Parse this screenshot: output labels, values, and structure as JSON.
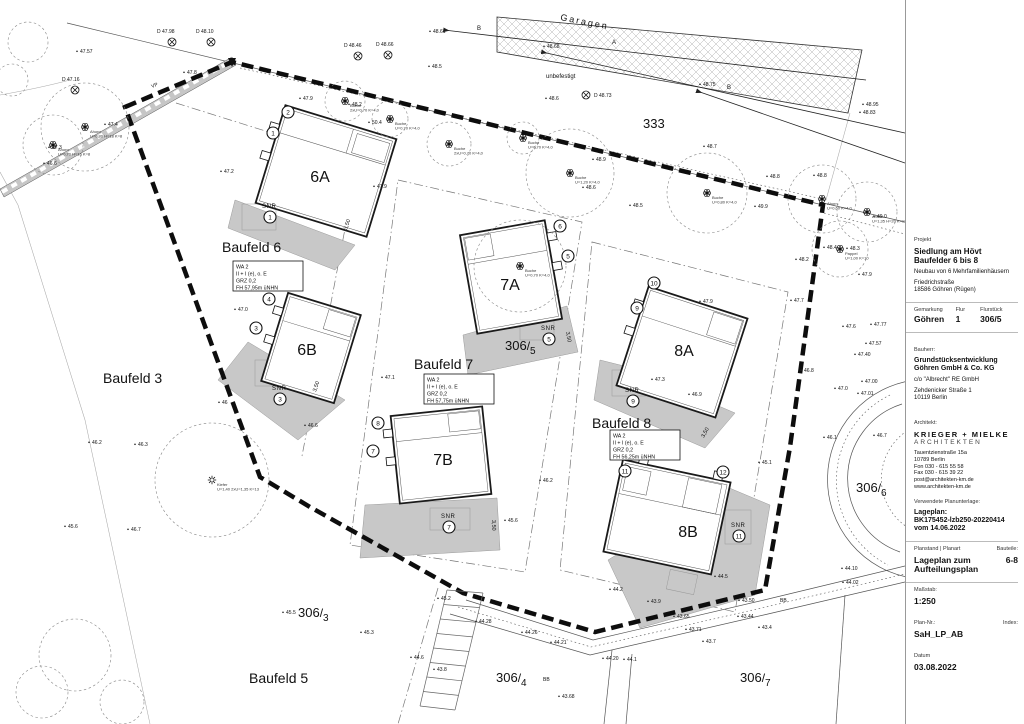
{
  "accent_colors": {
    "line_black": "#111111",
    "terrace_gray": "#c8c8c8",
    "crown_gray": "#858585"
  },
  "title_block": {
    "project": {
      "label": "Projekt",
      "title_line1": "Siedlung am Hövt",
      "title_line2": "Baufelder  6 bis 8",
      "description": "Neubau von 6 Mehrfamilienhäusern",
      "street": "Friedrichstraße",
      "city": "18586 Göhren (Rügen)"
    },
    "cadastre": {
      "gemarkung_label": "Gemarkung",
      "flur_label": "Flur",
      "flurstueck_label": "Flurstück",
      "gemarkung": "Göhren",
      "flur": "1",
      "flurstueck": "306/5"
    },
    "client": {
      "label": "Bauherr:",
      "name_line1": "Grundstücksentwicklung",
      "name_line2": "Göhren GmbH & Co. KG",
      "co": "c/o \"Albrecht\" RE GmbH",
      "street": "Zehdenicker Straße 1",
      "city": "10119 Berlin"
    },
    "architect": {
      "label": "Architekt:",
      "name": "KRIEGER + MIELKE",
      "subtitle": "ARCHITEKTEN",
      "street": "Tauentzienstraße 15a",
      "city": "10789 Berlin",
      "phone": "Fon 030 - 615 55 58",
      "fax": "Fax 030 - 615 39 22",
      "email": "post@architekten-km.de",
      "web": "www.architekten-km.de"
    },
    "plan_basis": {
      "label": "Verwendete Planunterlage:",
      "line1": "Lageplan:",
      "line2": "BK175452-lzb250-20220414",
      "line3": "vom 14.06.2022"
    },
    "plan_info": {
      "state_label": "Planstand | Planart",
      "component_label": "Bauteile:",
      "title_line1": "Lageplan zum",
      "title_line2": "Aufteilungsplan",
      "component": "6-8",
      "scale_label": "Maßstab:",
      "scale": "1:250",
      "plan_no_label": "Plan-Nr.:",
      "index_label": "Index:",
      "plan_no": "SaH_LP_AB",
      "date_label": "Datum",
      "date": "03.08.2022"
    }
  },
  "plan": {
    "baufeld_labels": [
      {
        "t": "Baufeld 6",
        "x": 222,
        "y": 252
      },
      {
        "t": "Baufeld 7",
        "x": 414,
        "y": 369
      },
      {
        "t": "Baufeld 8",
        "x": 592,
        "y": 428
      },
      {
        "t": "Baufeld 3",
        "x": 103,
        "y": 383
      },
      {
        "t": "Baufeld 5",
        "x": 249,
        "y": 683
      }
    ],
    "building_labels": [
      {
        "t": "6A",
        "x": 320,
        "y": 182
      },
      {
        "t": "6B",
        "x": 307,
        "y": 355
      },
      {
        "t": "7A",
        "x": 510,
        "y": 290
      },
      {
        "t": "7B",
        "x": 443,
        "y": 465
      },
      {
        "t": "8A",
        "x": 684,
        "y": 356
      },
      {
        "t": "8B",
        "x": 688,
        "y": 537
      }
    ],
    "spec_boxes": [
      {
        "x": 233,
        "y": 261,
        "lines": [
          "WA 2",
          "II + I (e), o. E",
          "GRZ 0,2",
          "FH 57,95m üNHN"
        ]
      },
      {
        "x": 424,
        "y": 374,
        "lines": [
          "WA 2",
          "II + I (e), o. E",
          "GRZ 0,2",
          "FH 57,75m üNHN"
        ]
      },
      {
        "x": 610,
        "y": 430,
        "lines": [
          "WA 2",
          "II + I (e), o. E",
          "GRZ 0,2",
          "FH 56,25m üNHN"
        ]
      }
    ],
    "parcel_labels": [
      {
        "num": "333",
        "x": 643,
        "y": 128
      },
      {
        "num": "306",
        "den": "5",
        "x": 505,
        "y": 350
      },
      {
        "num": "306",
        "den": "6",
        "x": 856,
        "y": 492
      },
      {
        "num": "306",
        "den": "3",
        "x": 298,
        "y": 617
      },
      {
        "num": "306",
        "den": "4",
        "x": 496,
        "y": 682
      },
      {
        "num": "306",
        "den": "7",
        "x": 740,
        "y": 682
      }
    ],
    "annotations": [
      {
        "t": "Garagen",
        "x": 560,
        "y": 20,
        "size": 9,
        "rot": 11,
        "spacing": 2
      },
      {
        "t": "A",
        "x": 612,
        "y": 44,
        "size": 6
      },
      {
        "t": "B",
        "x": 477,
        "y": 30,
        "size": 6
      },
      {
        "t": "B",
        "x": 727,
        "y": 89,
        "size": 6
      },
      {
        "t": "unbefestigt",
        "x": 546,
        "y": 78,
        "size": 6
      },
      {
        "t": "VP",
        "x": 152,
        "y": 88,
        "size": 5,
        "rot": -22
      },
      {
        "t": "BB",
        "x": 543,
        "y": 681,
        "size": 5
      },
      {
        "t": "BB",
        "x": 780,
        "y": 602,
        "size": 5
      }
    ],
    "dimensions": [
      {
        "t": "3,50",
        "x": 347,
        "y": 230,
        "rot": -72
      },
      {
        "t": "3,50",
        "x": 316,
        "y": 392,
        "rot": -72
      },
      {
        "t": "3,50",
        "x": 566,
        "y": 332,
        "rot": 80
      },
      {
        "t": "3,50",
        "x": 492,
        "y": 520,
        "rot": 88
      },
      {
        "t": "3,50",
        "x": 704,
        "y": 438,
        "rot": -62
      }
    ],
    "circled_numbers": [
      {
        "n": "1",
        "x": 273,
        "y": 133
      },
      {
        "n": "2",
        "x": 288,
        "y": 112
      },
      {
        "n": "3",
        "x": 256,
        "y": 328
      },
      {
        "n": "4",
        "x": 269,
        "y": 299
      },
      {
        "n": "5",
        "x": 568,
        "y": 256
      },
      {
        "n": "6",
        "x": 560,
        "y": 226
      },
      {
        "n": "7",
        "x": 373,
        "y": 451
      },
      {
        "n": "8",
        "x": 378,
        "y": 423
      },
      {
        "n": "9",
        "x": 637,
        "y": 308
      },
      {
        "n": "10",
        "x": 654,
        "y": 283
      },
      {
        "n": "11",
        "x": 625,
        "y": 471
      },
      {
        "n": "12",
        "x": 723,
        "y": 472
      }
    ],
    "snr_labels": [
      {
        "n": "1",
        "x": 262,
        "y": 208
      },
      {
        "n": "3",
        "x": 272,
        "y": 390
      },
      {
        "n": "5",
        "x": 541,
        "y": 330
      },
      {
        "n": "7",
        "x": 441,
        "y": 518
      },
      {
        "n": "9",
        "x": 625,
        "y": 392
      },
      {
        "n": "11",
        "x": 731,
        "y": 527
      }
    ],
    "survey_points": [
      {
        "t": "D 47.98",
        "sx": 172,
        "sy": 42,
        "tx": 157,
        "ty": 33
      },
      {
        "t": "D 48.10",
        "sx": 211,
        "sy": 42,
        "tx": 196,
        "ty": 33
      },
      {
        "t": "D 47.16",
        "sx": 75,
        "sy": 90,
        "tx": 62,
        "ty": 81
      },
      {
        "t": "D 48.73",
        "sx": 586,
        "sy": 95,
        "tx": 594,
        "ty": 97
      },
      {
        "t": "D 48.46",
        "sx": 358,
        "sy": 56,
        "tx": 344,
        "ty": 47
      },
      {
        "t": "D 48.66",
        "sx": 388,
        "sy": 55,
        "tx": 376,
        "ty": 46
      }
    ],
    "trees": [
      {
        "sp": "Ahorn",
        "info": "U=0,80 H=18 K=8",
        "x": 85,
        "y": 127,
        "r": 44,
        "type": "b"
      },
      {
        "sp": "Ahorn",
        "info": "U=0,70 H=16 K=8",
        "x": 53,
        "y": 145,
        "r": 30,
        "type": "b"
      },
      {
        "sp": "Buche",
        "info": "2xU=0,70 K=4,0",
        "x": 345,
        "y": 101,
        "r": 20,
        "type": "b"
      },
      {
        "sp": "Buche",
        "info": "U=0,70 K=4,0",
        "x": 390,
        "y": 119,
        "r": 18,
        "type": "b"
      },
      {
        "sp": "Buche",
        "info": "2xU=0,70 K=4,0",
        "x": 449,
        "y": 144,
        "r": 22,
        "type": "b"
      },
      {
        "sp": "Buche",
        "info": "U=0,70 K=4,0",
        "x": 523,
        "y": 138,
        "r": 16,
        "type": "b"
      },
      {
        "sp": "Buche",
        "info": "U=1,20 K=4,0",
        "x": 570,
        "y": 173,
        "r": 44,
        "type": "b"
      },
      {
        "sp": "Buche",
        "info": "U=0,80 K=4,0",
        "x": 707,
        "y": 193,
        "r": 40,
        "type": "b"
      },
      {
        "sp": "Ahorn",
        "info": "U=0,60 K=4,0",
        "x": 822,
        "y": 199,
        "r": 34,
        "type": "b"
      },
      {
        "sp": "Ahorn",
        "info": "U=1,35 H=20 K=12",
        "x": 867,
        "y": 212,
        "r": 30,
        "type": "b"
      },
      {
        "sp": "Pappel",
        "info": "U=1,00 K=10",
        "x": 840,
        "y": 249,
        "r": 28,
        "type": "b"
      },
      {
        "sp": "Kiefer",
        "info": "U=1,40 2xU=1,35 K=13",
        "x": 212,
        "y": 480,
        "r": 57,
        "type": "c"
      },
      {
        "sp": "Buche",
        "info": "U=0,70 K=4,0",
        "x": 520,
        "y": 266,
        "r": 46,
        "type": "b"
      }
    ],
    "shrub_crowns": [
      {
        "x": 75,
        "y": 655,
        "r": 36
      },
      {
        "x": 42,
        "y": 692,
        "r": 26
      },
      {
        "x": 122,
        "y": 702,
        "r": 22
      },
      {
        "x": 28,
        "y": 42,
        "r": 20
      },
      {
        "x": 12,
        "y": 80,
        "r": 16
      }
    ],
    "spot_elevations": [
      [
        "48.61",
        433,
        33
      ],
      [
        "48.5",
        432,
        68
      ],
      [
        "48.68",
        547,
        48
      ],
      [
        "48.75",
        703,
        86
      ],
      [
        "48.6",
        549,
        100
      ],
      [
        "47.57",
        80,
        53
      ],
      [
        "47.8",
        187,
        74
      ],
      [
        "47.4",
        108,
        126
      ],
      [
        "47.3",
        52,
        149
      ],
      [
        "46.6",
        47,
        165
      ],
      [
        "47.2",
        224,
        173
      ],
      [
        "47.9",
        303,
        100
      ],
      [
        "48.2",
        352,
        106
      ],
      [
        "50.4",
        372,
        124
      ],
      [
        "47.9",
        377,
        188
      ],
      [
        "48.9",
        596,
        161
      ],
      [
        "48.6",
        586,
        189
      ],
      [
        "48.5",
        633,
        207
      ],
      [
        "48.7",
        707,
        148
      ],
      [
        "48.8",
        770,
        178
      ],
      [
        "49.9",
        758,
        208
      ],
      [
        "48.8",
        817,
        177
      ],
      [
        "48.2",
        799,
        261
      ],
      [
        "48.4",
        827,
        249
      ],
      [
        "48.3",
        850,
        250
      ],
      [
        "47.9",
        862,
        276
      ],
      [
        "47.7",
        794,
        302
      ],
      [
        "47.6",
        846,
        328
      ],
      [
        "47.77",
        874,
        326
      ],
      [
        "47.57",
        869,
        345
      ],
      [
        "47.40",
        858,
        356
      ],
      [
        "47.00",
        865,
        383
      ],
      [
        "47.01",
        861,
        395
      ],
      [
        "47.0",
        838,
        390
      ],
      [
        "46.8",
        804,
        372
      ],
      [
        "46.1",
        827,
        439
      ],
      [
        "46.7",
        877,
        437
      ],
      [
        "48.95",
        866,
        106
      ],
      [
        "48.83",
        863,
        114
      ],
      [
        "49.0",
        877,
        218
      ],
      [
        "47.0",
        238,
        311
      ],
      [
        "47.1",
        385,
        379
      ],
      [
        "46.6",
        308,
        427
      ],
      [
        "46.2",
        543,
        482
      ],
      [
        "45.6",
        508,
        522
      ],
      [
        "47.9",
        703,
        303
      ],
      [
        "47.3",
        655,
        381
      ],
      [
        "46.9",
        692,
        396
      ],
      [
        "45.1",
        762,
        464
      ],
      [
        "46.2",
        92,
        444
      ],
      [
        "46.3",
        138,
        446
      ],
      [
        "45.6",
        68,
        528
      ],
      [
        "46.7",
        131,
        531
      ],
      [
        "46",
        222,
        404
      ],
      [
        "45.5",
        286,
        614
      ],
      [
        "45.3",
        364,
        634
      ],
      [
        "45.2",
        441,
        600
      ],
      [
        "44.6",
        414,
        659
      ],
      [
        "43.8",
        437,
        671
      ],
      [
        "44.28",
        479,
        623
      ],
      [
        "44.26",
        525,
        634
      ],
      [
        "44.21",
        554,
        644
      ],
      [
        "43.68",
        562,
        698
      ],
      [
        "44.2",
        613,
        591
      ],
      [
        "43.9",
        651,
        603
      ],
      [
        "43.50",
        742,
        602
      ],
      [
        "43.65",
        677,
        618
      ],
      [
        "43.71",
        689,
        631
      ],
      [
        "43.7",
        706,
        643
      ],
      [
        "43.44",
        741,
        618
      ],
      [
        "43.4",
        762,
        629
      ],
      [
        "44.10",
        845,
        570
      ],
      [
        "44.02",
        846,
        584
      ],
      [
        "44.20",
        606,
        660
      ],
      [
        "44.1",
        627,
        661
      ],
      [
        "44.5",
        718,
        578
      ]
    ]
  }
}
